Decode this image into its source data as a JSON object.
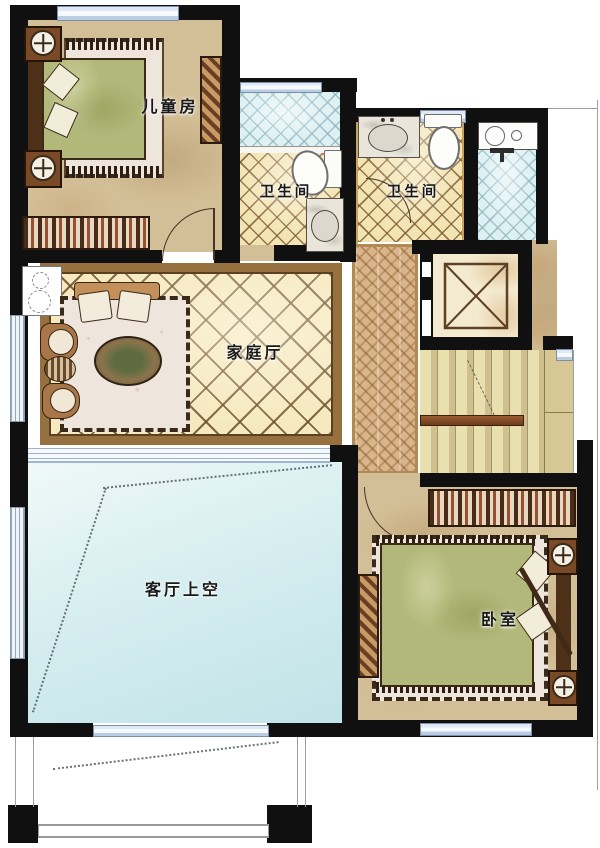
{
  "plan": {
    "type": "residential-floor-plan",
    "style": "watercolor"
  },
  "labels": {
    "children_room": "儿童房",
    "bath_left": "卫生间",
    "bath_right": "卫生间",
    "family_hall": "家庭厅",
    "living_void": "客厅上空",
    "bedroom": "卧室"
  },
  "rooms": [
    {
      "id": "children-room",
      "label": "儿童房",
      "fixtures": [
        "bed",
        "rug",
        "nightstand",
        "nightstand",
        "wardrobe",
        "dresser",
        "window",
        "door"
      ]
    },
    {
      "id": "bathroom-left",
      "label": "卫生间",
      "fixtures": [
        "shower-area",
        "toilet",
        "sink",
        "window"
      ]
    },
    {
      "id": "bathroom-right",
      "label": "卫生间",
      "fixtures": [
        "sink",
        "toilet",
        "window",
        "door"
      ]
    },
    {
      "id": "laundry-area",
      "label": "",
      "fixtures": [
        "counter",
        "basin",
        "faucet"
      ]
    },
    {
      "id": "family-hall",
      "label": "家庭厅",
      "fixtures": [
        "sofa",
        "armchair",
        "armchair",
        "side-table",
        "coffee-table",
        "rug",
        "window"
      ]
    },
    {
      "id": "corridor",
      "label": "",
      "fixtures": [
        "parquet-floor"
      ]
    },
    {
      "id": "elevator",
      "label": "",
      "fixtures": [
        "shaft-cross"
      ]
    },
    {
      "id": "stairs",
      "label": "",
      "fixtures": [
        "treads",
        "handrail",
        "direction-arrow"
      ]
    },
    {
      "id": "living-room-void",
      "label": "客厅上空",
      "fixtures": [
        "window",
        "sight-lines"
      ]
    },
    {
      "id": "bedroom",
      "label": "卧室",
      "fixtures": [
        "bed",
        "rug",
        "wardrobe",
        "dresser",
        "nightstand",
        "nightstand",
        "window",
        "door"
      ]
    },
    {
      "id": "terrace-below",
      "label": "",
      "fixtures": [
        "railing",
        "outline"
      ]
    }
  ],
  "colors": {
    "wall": "#101010",
    "floor_tan": "#d3bf97",
    "tile_cream": "#f3e4b4",
    "tile_line": "#7a5830",
    "tile_blue": "#ddf0f2",
    "void_cyan": "#d7eef0",
    "wood_trim": "#b08a52",
    "stair_tread": "#d6c794",
    "handrail": "#6e3c1c",
    "bed_green": "#b2b87a",
    "rug_cream": "#eee5dc"
  }
}
